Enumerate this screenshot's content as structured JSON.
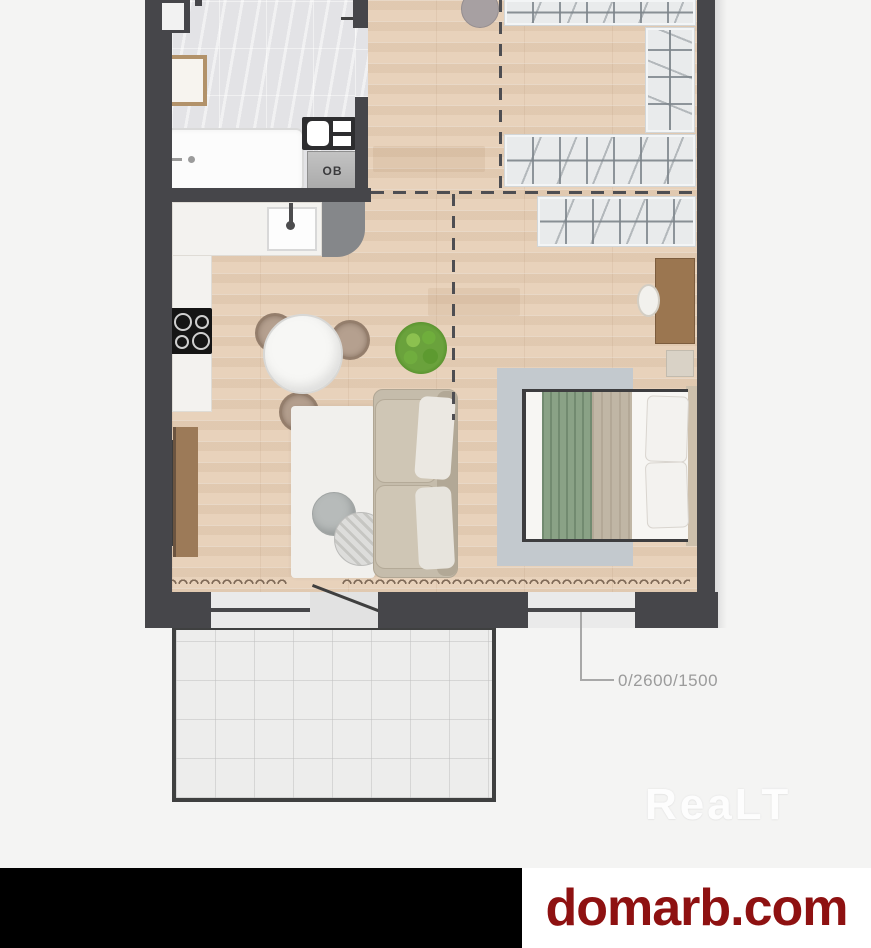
{
  "texts": {
    "washer_label": "OB",
    "window_dimension": "0/2600/1500",
    "watermark": "ReaLT",
    "banner_site": "domarb.com"
  },
  "palette": {
    "page_background": "#f4f4f3",
    "wall": "#46464a",
    "wood_floor": "#e8d2bb",
    "tile_floor": "#e3e3e6",
    "wardrobe_unit": "#e9ebec",
    "dashed_line": "#4e4e52",
    "plant_green": "#5f9c3a",
    "bed_blanket_green": "#8aa286",
    "banner_left_bg": "#000000",
    "banner_right_bg": "#ffffff",
    "banner_text_color": "#8e1111",
    "dimension_text_color": "#9b9b9b"
  }
}
